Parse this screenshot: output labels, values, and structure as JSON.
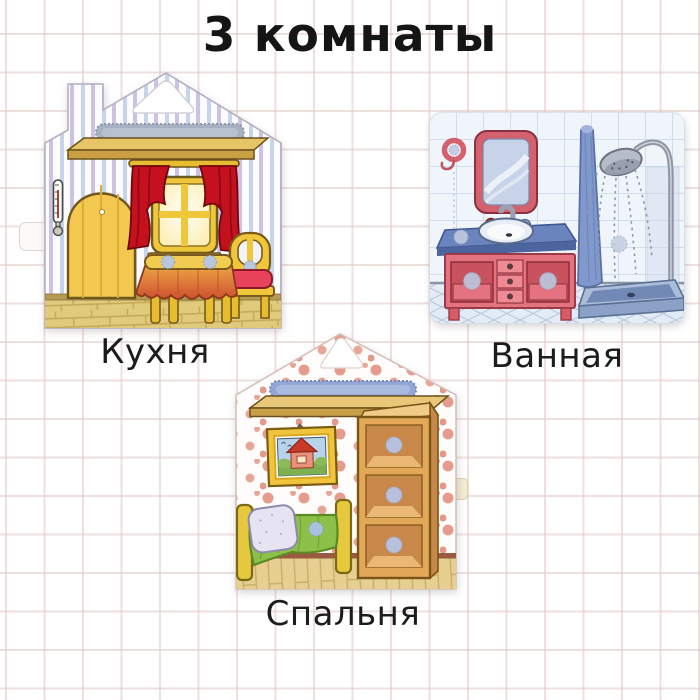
{
  "title": "3 комнаты",
  "style": {
    "background_color": "#ffffff",
    "grid_line_color": "#f0dede",
    "title_color": "#151515",
    "label_color": "#1c1c1c"
  },
  "rooms": [
    {
      "label": "Кухня",
      "card_shape": "house-with-triangle-handle-hole",
      "wallpaper": "vertical blue and lilac stripes",
      "depicted_items": [
        "gray-velcro-strip",
        "wall-shelf",
        "thermometer",
        "arched-yellow-door",
        "window-with-red-curtains",
        "curtain-rod",
        "table-with-red-tablecloth",
        "yellow-chair-with-red-cushion",
        "velcro-dots",
        "wooden-floor"
      ],
      "colors": {
        "furniture_yellow": "#f0c63a",
        "curtains_red": "#c5101e",
        "tablecloth": "#d2552f",
        "stripe_blue": "#c6d5ec",
        "stripe_lilac": "#c3b8de",
        "velcro_strip_gray": "#a7b1c2",
        "floor": "#e0ca7c"
      }
    },
    {
      "label": "Ванная",
      "card_shape": "rounded-rectangle",
      "wallpaper": "light blue wall tiles",
      "depicted_items": [
        "towel-ring-hook",
        "mirror",
        "faucet",
        "red-and-blue-cups",
        "sink",
        "blue-countertop",
        "pink-vanity-cabinet",
        "three-drawers",
        "velcro-dots",
        "hanging-blue-towel",
        "shower-pipe",
        "shower-head",
        "water-drops",
        "shower-tray",
        "diamond-tiled-floor"
      ],
      "colors": {
        "vanity_pink": "#e4737f",
        "countertop_blue": "#6a84bd",
        "mirror_frame": "#d4616e",
        "towel_blue": "#8099cc",
        "tile_line": "#cfdded",
        "tray_blue": "#7b93be"
      }
    },
    {
      "label": "Спальня",
      "card_shape": "house-with-triangle-handle-hole",
      "wallpaper": "white with pink polka dots",
      "depicted_items": [
        "blue-velcro-strip",
        "wall-shelf",
        "framed-house-picture",
        "storage-shelf-unit",
        "velcro-dots",
        "bed",
        "pillow",
        "green-blanket",
        "wooden-floor"
      ],
      "colors": {
        "dots_pink": "#e59c8c",
        "picture_frame_yellow": "#f0c43c",
        "blanket_green": "#8cc048",
        "shelf_unit_wood": "#e2a858",
        "velcro_strip_blue": "#93a6d6",
        "floor": "#e7cf92"
      }
    }
  ]
}
